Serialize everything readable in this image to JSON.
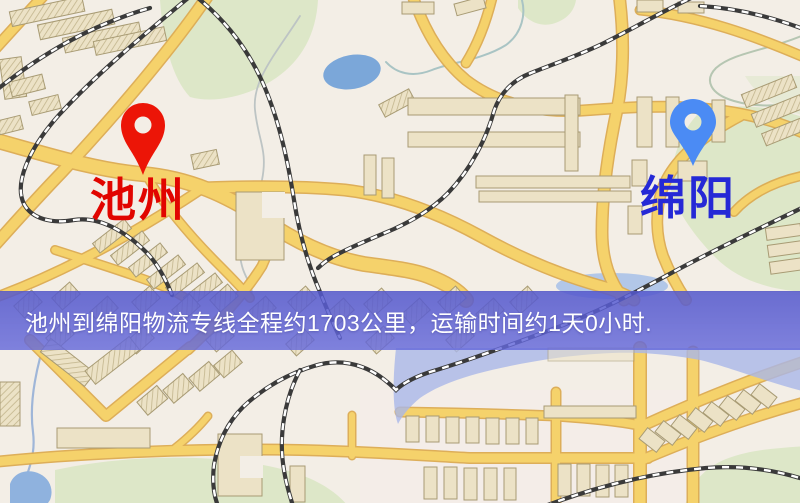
{
  "map": {
    "origin": {
      "name": "池州",
      "label_color": "#e10500",
      "pin_color": "#ec1507"
    },
    "destination": {
      "name": "绵阳",
      "label_color": "#2529d6",
      "pin_color": "#4b8bf4"
    }
  },
  "banner": {
    "text": "池州到绵阳物流专线全程约1703公里，运输时间约1天0小时.",
    "text_color": "#ffffff",
    "background_color": "#585cd0"
  },
  "map_colors": {
    "background": "#f3eee6",
    "road": "#f5d26b",
    "road_casing": "#dcab52",
    "park": "#dde7c8",
    "pond": "#7ba7d9",
    "river_overlay": "#a9b6e9",
    "railway": "#3a3a3a",
    "building_fill": "#ece2c6",
    "building_stroke": "#a89b74"
  }
}
